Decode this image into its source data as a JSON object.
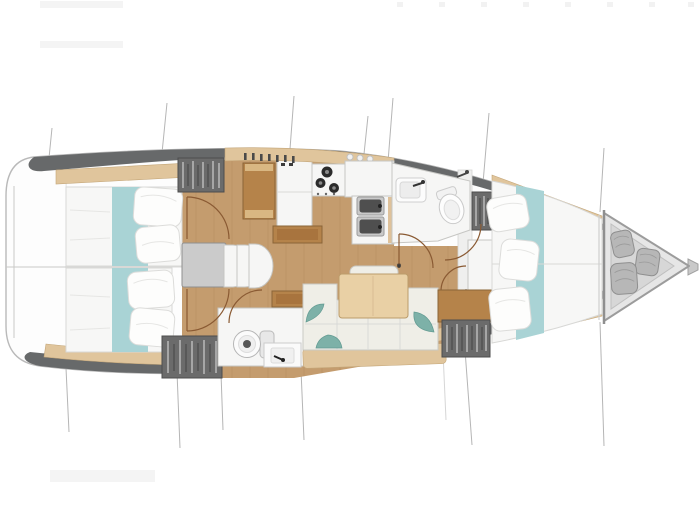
{
  "diagram": {
    "type": "floorplan",
    "subject": "Sailing yacht interior layout plan, top view, bow pointing right",
    "areas": [
      "aft cabin port with double berth",
      "aft cabin starboard with double berth",
      "companionway steps",
      "navigation station with seat and chart table",
      "galley with stove and double sink",
      "saloon with settee and table",
      "aft head with toilet and washbasin",
      "forward head with toilet and washbasin",
      "forward cabin with double berth",
      "bow sail locker with sail bags"
    ],
    "fixtures": {
      "double_berths": 3,
      "heads": 2,
      "toilets": 2,
      "washbasins": 2,
      "galley_sinks": 2,
      "stove_burners": 3,
      "companionway_steps": 3,
      "hanging_lockers": 4,
      "sail_bags": 3,
      "door_swings": 6,
      "hull_section_lines": 7
    }
  },
  "colors": {
    "hull-band": "#67696a",
    "hull-outline": "#b9b9b9",
    "wood-floor": "#c49c6e",
    "wood-trim": "#e0c59c",
    "wood-dark": "#b5834a",
    "bed-white": "#f7f7f6",
    "teal": "#a9d3d5",
    "sofa": "#efeee7",
    "sofa-teal": "#7db1a8",
    "locker": "#6b6b6b",
    "bag": "#b7b7b7",
    "steel": "#4f4f4f",
    "line": "#b5b5b5",
    "arc": "#8a5a33"
  }
}
